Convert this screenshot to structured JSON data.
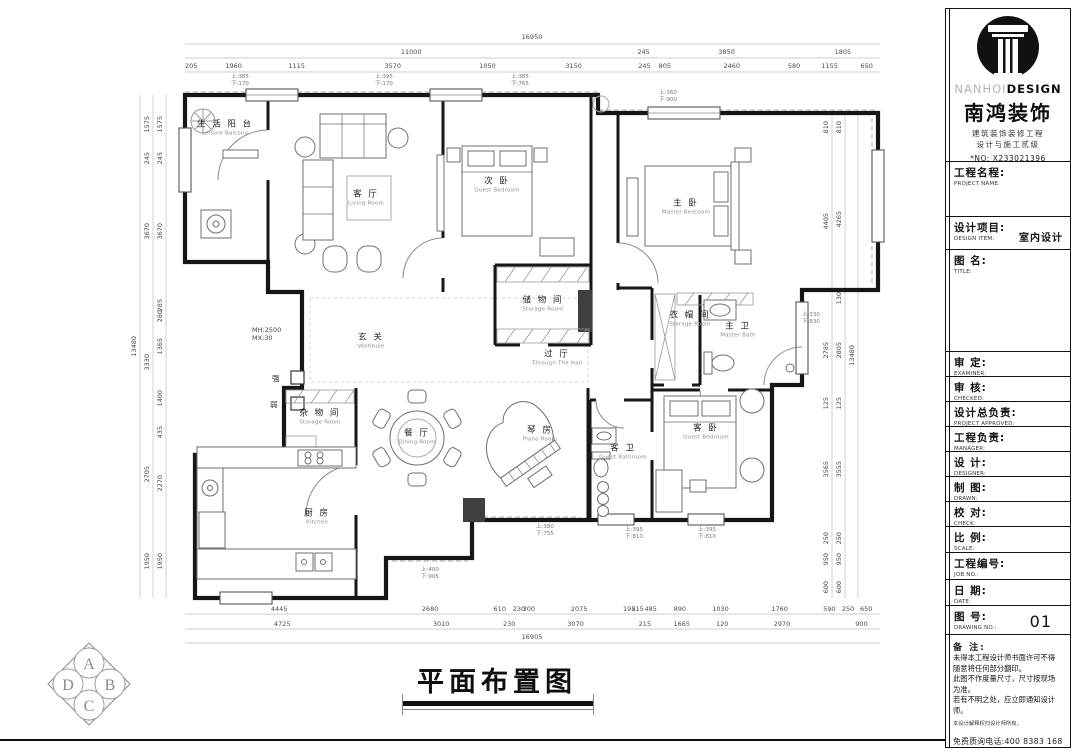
{
  "plan": {
    "drawing_title": "平面布置图",
    "rooms": [
      {
        "cn": "生 活 阳 台",
        "en": "Leisure Balcony"
      },
      {
        "cn": "客 厅",
        "en": "Living Room"
      },
      {
        "cn": "次 卧",
        "en": "Guest Bedroom"
      },
      {
        "cn": "主 卧",
        "en": "Master Bedroom"
      },
      {
        "cn": "储 物 间",
        "en": "Storage Room"
      },
      {
        "cn": "玄 关",
        "en": "Vestibule"
      },
      {
        "cn": "过 厅",
        "en": "Through The Hall"
      },
      {
        "cn": "衣 帽 间",
        "en": "Storage Room"
      },
      {
        "cn": "主 卫",
        "en": "Master Bath"
      },
      {
        "cn": "杂 物 间",
        "en": "Storage Room"
      },
      {
        "cn": "餐 厅",
        "en": "Dining Room"
      },
      {
        "cn": "琴 房",
        "en": "Piano Room"
      },
      {
        "cn": "厨 房",
        "en": "Kitchen"
      },
      {
        "cn": "客 卫",
        "en": "Guest Bathroom"
      },
      {
        "cn": "客 卧",
        "en": "Guest Bedroom"
      }
    ],
    "annotations": [
      {
        "l1": "上:385",
        "l2": "下:170"
      },
      {
        "l1": "上:395",
        "l2": "下:170"
      },
      {
        "l1": "上:385",
        "l2": "下:765"
      },
      {
        "l1": "上:360",
        "l2": "下:900"
      },
      {
        "l1": "上:330",
        "l2": "下:830"
      },
      {
        "l1": "上:380",
        "l2": "下:755"
      },
      {
        "l1": "上:395",
        "l2": "下:810"
      },
      {
        "l1": "上:395",
        "l2": "下:810"
      },
      {
        "l1": "上:400",
        "l2": "下:905"
      }
    ],
    "wall_note_1": "MH:2500",
    "wall_note_2": "MX:30",
    "strong": "强",
    "weak": "弱"
  },
  "dims": {
    "top1": "16950",
    "top2": [
      "11000",
      "245",
      "3850",
      "1805"
    ],
    "top3": [
      "205",
      "1960",
      "1115",
      "3570",
      "1050",
      "3150",
      "245",
      "805",
      "2460",
      "580",
      "1155",
      "650"
    ],
    "bottom1": [
      "4445",
      "2680",
      "610",
      "230",
      "300",
      "2075",
      "195",
      "215",
      "485",
      "890",
      "1030",
      "1760",
      "590",
      "250",
      "650"
    ],
    "bottom2": [
      "4725",
      "3010",
      "230",
      "3070",
      "215",
      "1665",
      "120",
      "2970",
      "900"
    ],
    "bottom3": "16905",
    "left_total": "13480",
    "left_outer": [
      "1575",
      "245",
      "3670",
      "3330",
      "2705",
      "1950"
    ],
    "left_inner": [
      "1575",
      "245",
      "3670",
      "285",
      "280",
      "1365",
      "1400",
      "435",
      "2270",
      "1950"
    ],
    "right_total": "13480",
    "right_outer": [
      "810",
      "4265",
      "130",
      "2805",
      "125",
      "3555",
      "250",
      "950",
      "600"
    ],
    "right_inner": [
      "810",
      "4405",
      "2785",
      "125",
      "3565",
      "250",
      "950",
      "600"
    ]
  },
  "compass": {
    "a": "A",
    "b": "B",
    "c": "C",
    "d": "D"
  },
  "titleblock": {
    "brand_gray": "NANHOI",
    "brand_black": "DESIGN",
    "company": "南鸿装饰",
    "cert1": "建筑装饰装修工程",
    "cert2": "设计与施工贰级",
    "cert_no": "*NO: X233021396",
    "rows": [
      {
        "cn": "工程名程:",
        "en": "PROJECT NAME:",
        "val": ""
      },
      {
        "cn": "设计项目:",
        "en": "DESIGN ITEM:",
        "val": "室内设计"
      },
      {
        "cn": "图  名:",
        "en": "TITLE:",
        "val": ""
      },
      {
        "cn": "审  定:",
        "en": "EXAMINER:",
        "val": ""
      },
      {
        "cn": "审  核:",
        "en": "CHECKED:",
        "val": ""
      },
      {
        "cn": "设计总负责:",
        "en": "PROJECT APPROVED:",
        "val": ""
      },
      {
        "cn": "工程负责:",
        "en": "MANAGER:",
        "val": ""
      },
      {
        "cn": "设  计:",
        "en": "DESIGNER:",
        "val": ""
      },
      {
        "cn": "制  图:",
        "en": "DRAWN:",
        "val": ""
      },
      {
        "cn": "校  对:",
        "en": "CHECK:",
        "val": ""
      },
      {
        "cn": "比  例:",
        "en": "SCALE:",
        "val": ""
      },
      {
        "cn": "工程编号:",
        "en": "JOB NO.:",
        "val": ""
      },
      {
        "cn": "日  期:",
        "en": "DATE:",
        "val": ""
      },
      {
        "cn": "图  号:",
        "en": "DRAWING NO.:",
        "val": "01"
      }
    ],
    "remark_title": "备 注:",
    "remarks": [
      "未得本工程设计师书面许可不得",
      "随意将任何部分翻印。",
      "此图不作度量尺寸，尺寸按现场",
      "为准。",
      "若有不明之处，应立即通知设计",
      "师。"
    ],
    "remark_small": "本设计解释权归设计师所有。",
    "phone": "免费质询电话:400 8383 168"
  }
}
